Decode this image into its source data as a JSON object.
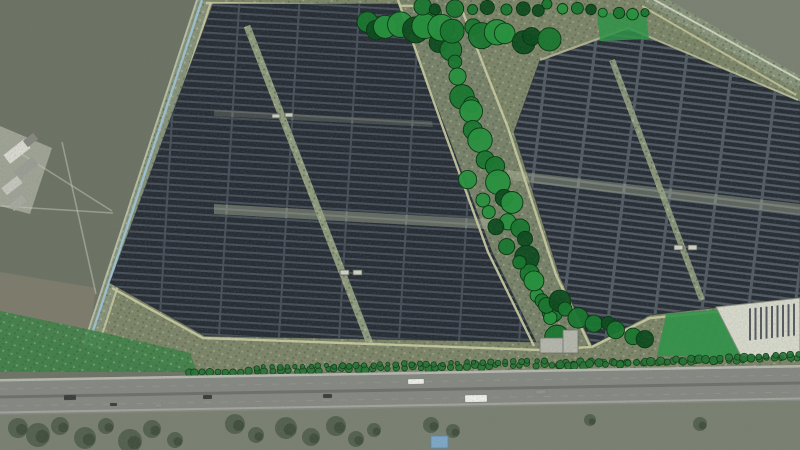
{
  "scene": {
    "alt": "Aerial visualization of a solar farm beside a motorway: dark panel arrays, tree belts, green landscape patches, ditch boundaries, fields and vehicles on the road",
    "canvas": {
      "width": 800,
      "height": 450
    },
    "colors": {
      "field_left": "#6c7365",
      "field_right": "#7b8173",
      "farm_scrub": "#7d8569",
      "verge": "#7a8172",
      "ditch_water": "#9dc0d0",
      "path_tan": "#c6c8a0",
      "panel_dark": "#272d35",
      "panel_gapL": "#47505a",
      "panel_gapR": "#525b64",
      "green_patch": "#2d9447",
      "green_wedge": "#3b8247",
      "pad": "#d6d8cc",
      "pad_slot": "#3f454c",
      "building": "#b4b6ac",
      "highway_asphalt": "#868983",
      "highway_median": "#6e716b",
      "highway_line": "#b6b8b0",
      "highway_shoulder": "#a3a59d",
      "vehicle_white": "#edefe9",
      "vehicle_dark": "#3b3e3a",
      "vehicle_gray": "#8f9289",
      "blue_object": "#7ea8c8",
      "tree_dark": "#0c4a1d",
      "tree_mid": "#17762e",
      "tree_light": "#25913d",
      "tree_outline": "#06370f",
      "shrub_fill": "#247333",
      "shrub_stroke": "#123f1c"
    },
    "sections": [
      {
        "name": "left-field",
        "kind": "polygon",
        "points": "0,0 206,0 93,348 0,348",
        "fill": "field_left"
      },
      {
        "name": "brown-patch",
        "kind": "polygon",
        "points": "0,272 96,288 88,346 0,332",
        "fill": "#857f6f",
        "opacity": 0.7
      },
      {
        "name": "field-paths",
        "kind": "lines",
        "items": [
          [
            0,
            206,
            113,
            213
          ],
          [
            62,
            142,
            96,
            294
          ],
          [
            20,
            153,
            112,
            211
          ]
        ],
        "stroke": "#c9cbb8",
        "width": 1.6,
        "opacity": 0.5
      },
      {
        "name": "right-field",
        "kind": "polygon",
        "points": "653,0 800,0 800,88",
        "fill": "field_right"
      },
      {
        "name": "farm-scrub-base",
        "kind": "polygon",
        "points": "206,0 653,0 800,88 800,372 196,372 92,348",
        "fill": "farm_scrub",
        "speckle": true
      },
      {
        "name": "corridor",
        "kind": "polygon",
        "points": "398,0 458,0 508,128 556,275 590,346 534,346 488,252 443,128",
        "fill": "#79826a",
        "speckle": true
      },
      {
        "name": "left-ditch-band",
        "kind": "line",
        "x1": 204,
        "y1": 0,
        "x2": 90,
        "y2": 348,
        "stroke": "#87927a",
        "width": 13,
        "speckle": true
      },
      {
        "name": "left-ditch-outer-line",
        "kind": "line",
        "x1": 197,
        "y1": 0,
        "x2": 84,
        "y2": 344,
        "stroke": "#b7bfa6",
        "width": 2
      },
      {
        "name": "left-ditch-water",
        "kind": "line",
        "x1": 202,
        "y1": 0,
        "x2": 88,
        "y2": 346,
        "stroke": "ditch_water",
        "width": 2.4
      },
      {
        "name": "left-ditch-inner-path",
        "kind": "line",
        "x1": 211,
        "y1": 2,
        "x2": 97,
        "y2": 350,
        "stroke": "path_tan",
        "width": 2.2,
        "opacity": 0.9
      },
      {
        "name": "tr-ditch-band",
        "kind": "line",
        "x1": 648,
        "y1": -4,
        "x2": 800,
        "y2": 84,
        "stroke": "#87927a",
        "width": 14,
        "speckle": true
      },
      {
        "name": "tr-ditch-line",
        "kind": "line",
        "x1": 651,
        "y1": -2,
        "x2": 800,
        "y2": 80,
        "stroke": "#ccd2bd",
        "width": 2
      },
      {
        "name": "tr-ditch-inner-path",
        "kind": "line",
        "x1": 642,
        "y1": 6,
        "x2": 796,
        "y2": 95,
        "stroke": "path_tan",
        "width": 2,
        "opacity": 0.85
      },
      {
        "name": "top-path",
        "kind": "line",
        "x1": 206,
        "y1": 3,
        "x2": 420,
        "y2": 6,
        "stroke": "path_tan",
        "width": 2.5,
        "opacity": 0.9
      },
      {
        "name": "panel-block-left",
        "kind": "block",
        "points": "213,4 398,4 445,128 492,252 536,342 205,336 110,283",
        "pattern": "panelsL"
      },
      {
        "name": "panel-block-right",
        "kind": "block",
        "points": "540,60 628,28 800,102 800,298 650,315 592,345 560,277 514,132",
        "pattern": "panelsR"
      },
      {
        "name": "light-band-left",
        "kind": "polygon",
        "points": "214,204 500,220 502,230 214,214",
        "fill": "#b9c1a4",
        "opacity": 0.42
      },
      {
        "name": "light-band-left-2",
        "kind": "polygon",
        "points": "214,110 432,121 433,127 214,116",
        "fill": "#b9c1a4",
        "opacity": 0.22
      },
      {
        "name": "light-band-right",
        "kind": "polygon",
        "points": "506,170 800,204 800,215 509,180",
        "fill": "#b9c1a4",
        "opacity": 0.38
      },
      {
        "name": "service-road-left",
        "kind": "line",
        "x1": 247,
        "y1": 26,
        "x2": 370,
        "y2": 344,
        "stroke": "#9aa585",
        "width": 7,
        "opacity": 0.9,
        "speckle": true
      },
      {
        "name": "service-road-right",
        "kind": "line",
        "x1": 612,
        "y1": 60,
        "x2": 702,
        "y2": 300,
        "stroke": "#9aa585",
        "width": 6,
        "opacity": 0.85,
        "speckle": true
      },
      {
        "name": "corridor-border-west",
        "kind": "polyline",
        "points": "398,0 443,128 488,252 534,346",
        "stroke": "path_tan",
        "width": 2.4,
        "opacity": 0.95
      },
      {
        "name": "corridor-border-east",
        "kind": "polyline",
        "points": "458,0 508,128 556,275 590,346",
        "stroke": "path_tan",
        "width": 2.4,
        "opacity": 0.95
      },
      {
        "name": "block-right-top-path",
        "kind": "polyline",
        "points": "540,60 628,28 798,100",
        "stroke": "path_tan",
        "width": 2,
        "opacity": 0.8
      },
      {
        "name": "bottom-path",
        "kind": "polyline",
        "points": "112,288 203,338 540,350 592,347 650,318 800,304",
        "stroke": "path_tan",
        "width": 2.4,
        "opacity": 0.95
      },
      {
        "name": "inverter-cabins",
        "kind": "rects",
        "items": [
          [
            340,
            270,
            9,
            5
          ],
          [
            353,
            270,
            9,
            5
          ],
          [
            272,
            114,
            8,
            4
          ],
          [
            285,
            113,
            8,
            4
          ],
          [
            674,
            245,
            9,
            5
          ],
          [
            688,
            245,
            9,
            5
          ]
        ],
        "fill": "#cfd2c6",
        "stroke": "#565b52"
      },
      {
        "name": "top-right-green-patch",
        "kind": "polygon",
        "points": "597,13 646,13 649,39 600,41",
        "fill": "green_patch",
        "opacity": 0.85
      },
      {
        "name": "bottom-right-green-patch",
        "kind": "polygon",
        "points": "657,356 666,314 748,307 743,357",
        "fill": "green_patch",
        "opacity": 0.9
      },
      {
        "name": "bottom-left-green-wedge",
        "kind": "polygon",
        "points": "0,311 96,331 190,353 197,372 0,372",
        "fill": "green_wedge",
        "opacity": 0.85,
        "speckle": true
      },
      {
        "name": "staging-pad",
        "kind": "polygon",
        "points": "716,307 800,298 800,359 741,356",
        "fill": "pad",
        "stroke": "#8a8d80"
      },
      {
        "name": "pad-slots",
        "kind": "slots",
        "count": 9,
        "x0": 750,
        "dx": 5.5,
        "len": 32,
        "stroke": "pad_slot",
        "width": 2
      },
      {
        "name": "tree-belts",
        "kind": "belts",
        "belts": [
          {
            "x1": 428,
            "y1": 12,
            "x2": 558,
            "y2": 336,
            "count": 26,
            "spread": 15,
            "rmin": 6.5,
            "rmax": 12.5
          },
          {
            "x1": 470,
            "y1": 180,
            "x2": 540,
            "y2": 300,
            "count": 8,
            "spread": 10,
            "rmin": 6,
            "rmax": 10
          },
          {
            "x1": 366,
            "y1": 24,
            "x2": 543,
            "y2": 40,
            "count": 15,
            "spread": 13,
            "rmin": 7.5,
            "rmax": 13.5
          },
          {
            "x1": 420,
            "y1": 8,
            "x2": 540,
            "y2": 12,
            "count": 8,
            "spread": 6,
            "rmin": 5,
            "rmax": 9
          },
          {
            "x1": 548,
            "y1": 6,
            "x2": 645,
            "y2": 14,
            "count": 8,
            "spread": 5,
            "rmin": 3.5,
            "rmax": 6
          },
          {
            "x1": 545,
            "y1": 300,
            "x2": 645,
            "y2": 344,
            "count": 9,
            "spread": 11,
            "rmin": 6.5,
            "rmax": 11
          }
        ]
      },
      {
        "name": "shrub-rows",
        "kind": "shrubrows",
        "rows": [
          {
            "x1": 188,
            "y1": 373,
            "x2": 798,
            "y2": 358,
            "count": 80,
            "r": 3.1,
            "jy": 1.6
          },
          {
            "x1": 256,
            "y1": 368,
            "x2": 544,
            "y2": 361,
            "count": 38,
            "r": 2.5,
            "jy": 1.2
          },
          {
            "x1": 560,
            "y1": 366,
            "x2": 798,
            "y2": 355,
            "count": 32,
            "r": 3.4,
            "jy": 1.5
          }
        ]
      },
      {
        "name": "substation-building",
        "kind": "rects",
        "items": [
          [
            540,
            338,
            38,
            15
          ],
          [
            563,
            330,
            15,
            23
          ]
        ],
        "fill": "building",
        "stroke": "#6e716a"
      },
      {
        "name": "farm-halo",
        "kind": "polygon",
        "points": "0,126 52,148 30,214 0,206",
        "fill": "#c9cabf",
        "opacity": 0.55
      },
      {
        "name": "farm-buildings",
        "kind": "rects",
        "rotate": -38,
        "items": [
          [
            4,
            146,
            26,
            11
          ],
          [
            14,
            163,
            24,
            10
          ],
          [
            2,
            181,
            20,
            9
          ],
          [
            24,
            136,
            13,
            8
          ],
          [
            10,
            199,
            16,
            8
          ]
        ],
        "fills": [
          "#d8d8d0",
          "#9a9d95",
          "#c4c5bc",
          "#84877f",
          "#a7a9a0"
        ]
      },
      {
        "name": "verge",
        "kind": "polygon",
        "points": "0,414 800,400 800,450 0,450",
        "fill": "verge"
      },
      {
        "name": "verge-tree-blobs",
        "kind": "blobs",
        "items": [
          [
            18,
            428,
            10
          ],
          [
            38,
            435,
            12
          ],
          [
            60,
            426,
            9
          ],
          [
            85,
            438,
            11
          ],
          [
            106,
            426,
            8
          ],
          [
            130,
            441,
            12
          ],
          [
            152,
            429,
            9
          ],
          [
            175,
            440,
            8
          ],
          [
            235,
            424,
            10
          ],
          [
            256,
            435,
            8
          ],
          [
            286,
            428,
            11
          ],
          [
            311,
            437,
            9
          ],
          [
            336,
            426,
            10
          ],
          [
            356,
            439,
            8
          ],
          [
            374,
            430,
            7
          ],
          [
            431,
            425,
            8
          ],
          [
            453,
            431,
            7
          ],
          [
            590,
            420,
            6
          ],
          [
            700,
            424,
            7
          ]
        ],
        "fill": "#42503e",
        "opacity": 0.65
      },
      {
        "name": "blue-object",
        "kind": "rects",
        "items": [
          [
            431,
            436,
            17,
            12
          ]
        ],
        "fill": "blue_object",
        "stroke": "#5d88a8"
      },
      {
        "name": "highway-base",
        "kind": "polygon",
        "points": "0,379 800,365 800,401 0,415",
        "fill": "highway_asphalt"
      },
      {
        "name": "highway-top-line",
        "kind": "polygon",
        "points": "0,379 800,365 800,367.5 0,381.5",
        "fill": "highway_line"
      },
      {
        "name": "highway-median",
        "kind": "polygon",
        "points": "0,395.5 800,381.5 800,384.5 0,398.5",
        "fill": "highway_median"
      },
      {
        "name": "highway-bottom-line",
        "kind": "polygon",
        "points": "0,411.5 800,397.5 800,399.5 0,413.5",
        "fill": "highway_shoulder"
      },
      {
        "name": "lane-dashes",
        "kind": "lines",
        "items": [
          [
            0,
            389,
            800,
            375
          ],
          [
            0,
            406,
            800,
            392
          ]
        ],
        "stroke": "#999c93",
        "width": 1,
        "opacity": 0.55,
        "dash": "7 10"
      },
      {
        "name": "vehicles",
        "kind": "vehicles",
        "items": [
          [
            408,
            379,
            16,
            5,
            "vehicle_white"
          ],
          [
            64,
            395,
            12,
            5,
            "vehicle_dark"
          ],
          [
            203,
            395,
            9,
            4,
            "vehicle_dark"
          ],
          [
            323,
            394,
            9,
            4,
            "vehicle_dark"
          ],
          [
            465,
            395,
            22,
            7,
            "vehicle_white"
          ],
          [
            536,
            390,
            10,
            4,
            "vehicle_gray"
          ],
          [
            110,
            403,
            7,
            3,
            "vehicle_dark"
          ],
          [
            155,
            404,
            7,
            3,
            "vehicle_gray"
          ]
        ]
      },
      {
        "name": "photo-grain",
        "kind": "grain"
      }
    ]
  }
}
